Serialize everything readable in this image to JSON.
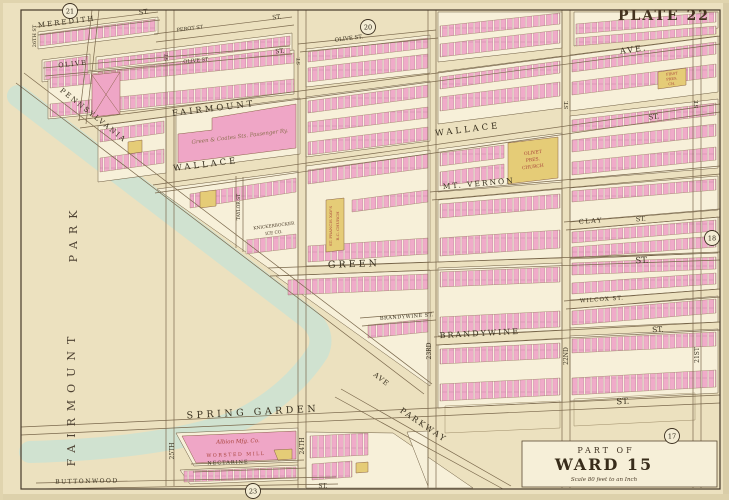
{
  "plate_title": "PLATE 22",
  "cartouche": {
    "part_of": "PART OF",
    "ward": "WARD 15",
    "scale": "Scale 80 feet to an Inch"
  },
  "adjacent_plate_circles": [
    {
      "num": "21",
      "x": 70,
      "y": 11
    },
    {
      "num": "20",
      "x": 368,
      "y": 27
    },
    {
      "num": "18",
      "x": 712,
      "y": 238
    },
    {
      "num": "17",
      "x": 672,
      "y": 436
    },
    {
      "num": "23",
      "x": 253,
      "y": 491
    }
  ],
  "street_labels": [
    {
      "text": "MEREDITH",
      "x": 67,
      "y": 24,
      "r": -7,
      "s": 7,
      "ls": 2
    },
    {
      "text": "ST.",
      "x": 144,
      "y": 14,
      "r": -7,
      "s": 6.5
    },
    {
      "text": "PEROT ST",
      "x": 190,
      "y": 30,
      "r": -7,
      "s": 5
    },
    {
      "text": "ST.",
      "x": 277,
      "y": 19,
      "r": -7,
      "s": 6
    },
    {
      "text": "OLIVE",
      "x": 73,
      "y": 66,
      "r": -6,
      "s": 6.5,
      "ls": 1.5
    },
    {
      "text": "OLIVE ST",
      "x": 196,
      "y": 62,
      "r": -6,
      "s": 5
    },
    {
      "text": "ST.",
      "x": 280,
      "y": 53,
      "r": -6,
      "s": 6
    },
    {
      "text": "OLIVE ST.",
      "x": 349,
      "y": 40,
      "r": -7,
      "s": 5.5
    },
    {
      "text": "FAIRMOUNT",
      "x": 214,
      "y": 111,
      "r": -7,
      "s": 8.5,
      "ls": 3
    },
    {
      "text": "AVE.",
      "x": 634,
      "y": 52,
      "r": -8,
      "s": 8,
      "ls": 2
    },
    {
      "text": "WALLACE",
      "x": 206,
      "y": 167,
      "r": -7,
      "s": 8.5,
      "ls": 3
    },
    {
      "text": "WALLACE",
      "x": 468,
      "y": 132,
      "r": -7,
      "s": 8.5,
      "ls": 3
    },
    {
      "text": "ST.",
      "x": 654,
      "y": 119,
      "r": -7,
      "s": 7
    },
    {
      "text": "MT. VERNON",
      "x": 479,
      "y": 186,
      "r": -5,
      "s": 7.5,
      "ls": 2
    },
    {
      "text": "CLAY",
      "x": 591,
      "y": 223,
      "r": -4,
      "s": 6.5,
      "ls": 1.5
    },
    {
      "text": "ST.",
      "x": 641,
      "y": 221,
      "r": -4,
      "s": 6.5
    },
    {
      "text": "GREEN",
      "x": 354,
      "y": 267,
      "r": -2,
      "s": 9.5,
      "ls": 3
    },
    {
      "text": "ST.",
      "x": 642,
      "y": 263,
      "r": -2,
      "s": 8.5
    },
    {
      "text": "WILCOX ST.",
      "x": 602,
      "y": 301,
      "r": -4,
      "s": 5.5,
      "ls": 1
    },
    {
      "text": "BRANDYWINE ST.",
      "x": 407,
      "y": 318,
      "r": -4,
      "s": 5,
      "ls": 0.5
    },
    {
      "text": "BRANDYWINE",
      "x": 480,
      "y": 336,
      "r": -3,
      "s": 8,
      "ls": 2
    },
    {
      "text": "ST.",
      "x": 658,
      "y": 332,
      "r": -3,
      "s": 7.5
    },
    {
      "text": "SPRING GARDEN",
      "x": 253,
      "y": 415,
      "r": -3,
      "s": 9.5,
      "ls": 3.5
    },
    {
      "text": "ST.",
      "x": 623,
      "y": 404,
      "r": -3,
      "s": 8.5
    },
    {
      "text": "NECTARINE",
      "x": 228,
      "y": 464,
      "r": -2,
      "s": 5,
      "ls": 1
    },
    {
      "text": "BUTTONWOOD",
      "x": 87,
      "y": 483,
      "r": -1,
      "s": 6,
      "ls": 1.5
    },
    {
      "text": "ST.",
      "x": 323,
      "y": 488,
      "r": 0,
      "s": 6
    },
    {
      "text": "PENNSYLVANIA",
      "x": 92,
      "y": 117,
      "r": 38.5,
      "s": 7,
      "ls": 2
    },
    {
      "text": "AVE",
      "x": 380,
      "y": 381,
      "r": 38,
      "s": 7,
      "ls": 1
    },
    {
      "text": "PARKWAY",
      "x": 422,
      "y": 427,
      "r": 34,
      "s": 8,
      "ls": 2
    },
    {
      "text": "25TH",
      "x": 174,
      "y": 451,
      "r": -90,
      "s": 6
    },
    {
      "text": "24TH",
      "x": 304,
      "y": 446,
      "r": -90,
      "s": 6
    },
    {
      "text": "23RD",
      "x": 431,
      "y": 351,
      "r": -90,
      "s": 6
    },
    {
      "text": "22ND",
      "x": 568,
      "y": 356,
      "r": -90,
      "s": 6
    },
    {
      "text": "21ST",
      "x": 699,
      "y": 355,
      "r": -90,
      "s": 6
    },
    {
      "text": "26TH ST",
      "x": 36,
      "y": 36,
      "r": -90,
      "s": 5
    },
    {
      "text": "ST.",
      "x": 168,
      "y": 57,
      "r": -90,
      "s": 5
    },
    {
      "text": "ST.",
      "x": 300,
      "y": 61,
      "r": -90,
      "s": 5
    },
    {
      "text": "ST.",
      "x": 568,
      "y": 105,
      "r": -90,
      "s": 5.5
    },
    {
      "text": "ST.",
      "x": 698,
      "y": 104,
      "r": -90,
      "s": 5.5
    },
    {
      "text": "TAYLOR ST",
      "x": 240,
      "y": 207,
      "r": -90,
      "s": 4.5
    }
  ],
  "park_labels": [
    {
      "text": "FAIRMOUNT",
      "x": 75,
      "y": 398,
      "r": -90,
      "s": 11,
      "ls": 7
    },
    {
      "text": "PARK",
      "x": 77,
      "y": 233,
      "r": -90,
      "s": 11,
      "ls": 7
    }
  ],
  "building_labels": [
    {
      "text": "OLIVET",
      "x": 533,
      "y": 154,
      "r": -7,
      "s": 4.5,
      "k": "red"
    },
    {
      "text": "PRES.",
      "x": 533,
      "y": 161,
      "r": -7,
      "s": 4.5,
      "k": "red"
    },
    {
      "text": "CHURCH",
      "x": 533,
      "y": 168,
      "r": -7,
      "s": 4.5,
      "k": "red"
    },
    {
      "text": "ST. FRANCIS XAV'S",
      "x": 332,
      "y": 226,
      "r": -90,
      "s": 4,
      "k": "red"
    },
    {
      "text": "R.C. CHURCH",
      "x": 339,
      "y": 226,
      "r": -90,
      "s": 4,
      "k": "red"
    },
    {
      "text": "KNICKERBOCKER",
      "x": 274,
      "y": 227,
      "r": -7,
      "s": 4.3,
      "k": "dark"
    },
    {
      "text": "ICE CO.",
      "x": 274,
      "y": 234,
      "r": -7,
      "s": 4.3,
      "k": "dark"
    },
    {
      "text": "FIRST",
      "x": 672,
      "y": 75,
      "r": -6,
      "s": 3.6,
      "k": "red"
    },
    {
      "text": "PRES.",
      "x": 672,
      "y": 80,
      "r": -6,
      "s": 3.6,
      "k": "red"
    },
    {
      "text": "CH.",
      "x": 672,
      "y": 85,
      "r": -6,
      "s": 3.6,
      "k": "red"
    },
    {
      "text": "Green & Coates Sts. Passenger Ry.",
      "x": 240,
      "y": 138,
      "r": -7,
      "s": 5.5,
      "k": "script"
    },
    {
      "text": "Albion Mfg. Co.",
      "x": 238,
      "y": 443,
      "r": -2,
      "s": 5.5,
      "k": "script-red"
    },
    {
      "text": "WORSTED MILL",
      "x": 236,
      "y": 456,
      "r": -2,
      "s": 4.8,
      "ls": 1.5,
      "k": "red"
    }
  ]
}
